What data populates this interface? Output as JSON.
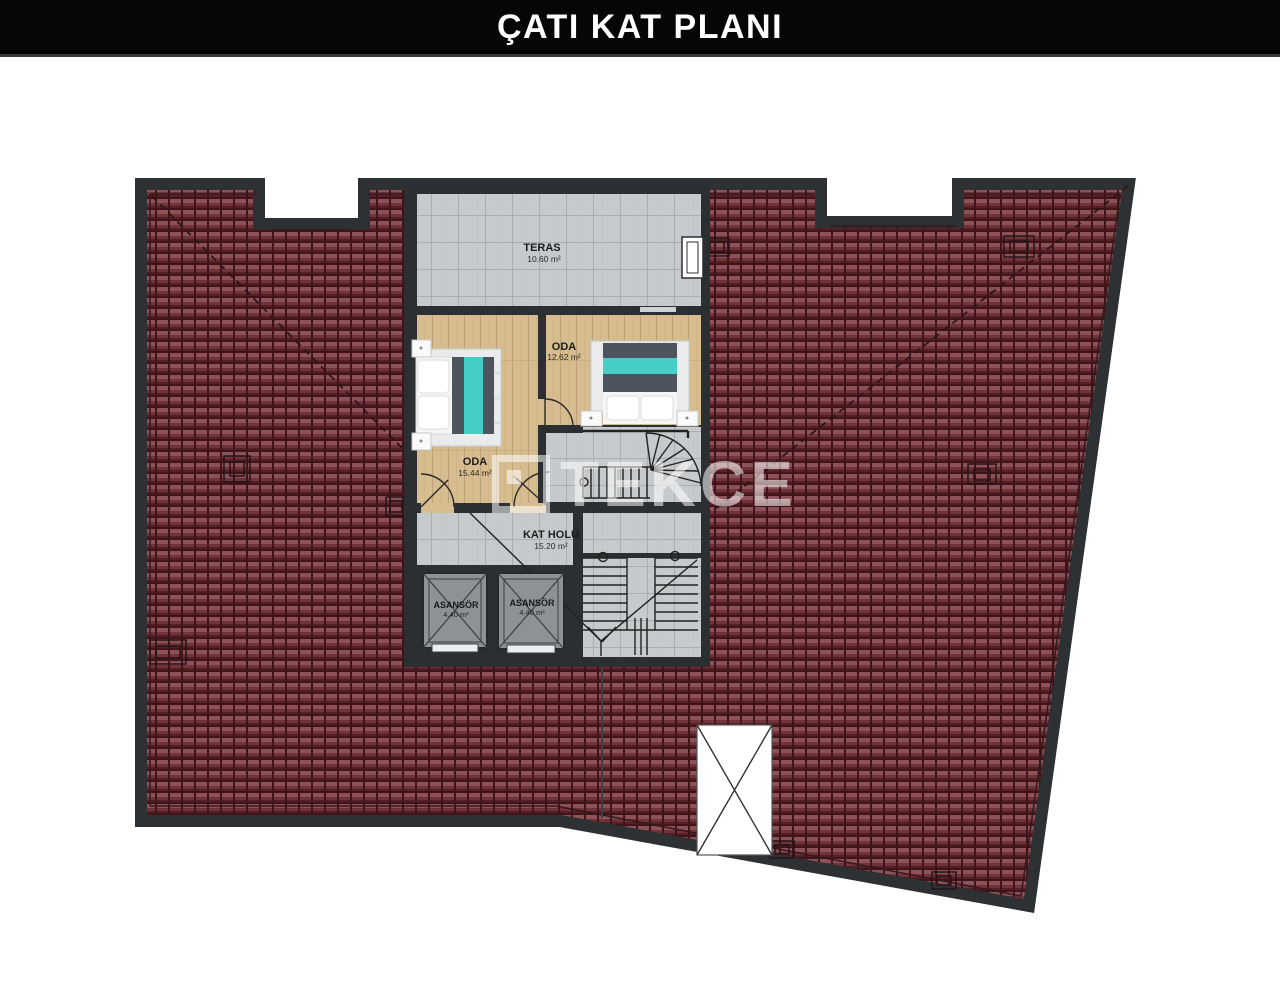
{
  "header": {
    "title": "ÇATI KAT PLANI"
  },
  "watermark": {
    "brand": "TEKCE"
  },
  "plan": {
    "terrace": {
      "label": "TERAS",
      "area": "10.60 m²"
    },
    "room_left": {
      "label": "ODA",
      "area": "15.44 m²"
    },
    "room_right": {
      "label": "ODA",
      "area": "12.62 m²"
    },
    "hall": {
      "label": "KAT HOLÜ",
      "area": "15.20 m²"
    },
    "elevator_left": {
      "label": "ASANSÖR",
      "area": "4.40 m²"
    },
    "elevator_right": {
      "label": "ASANSÖR",
      "area": "4.40 m²"
    }
  },
  "colors": {
    "roof_tile": "#71333a",
    "roof_border": "#2d3134",
    "wall": "#2b2f32",
    "wood_floor": "#d6bc8e",
    "tile_floor": "#c7cacc",
    "accent_turquoise": "#45cdc6",
    "duvet_gray": "#4e545e"
  }
}
